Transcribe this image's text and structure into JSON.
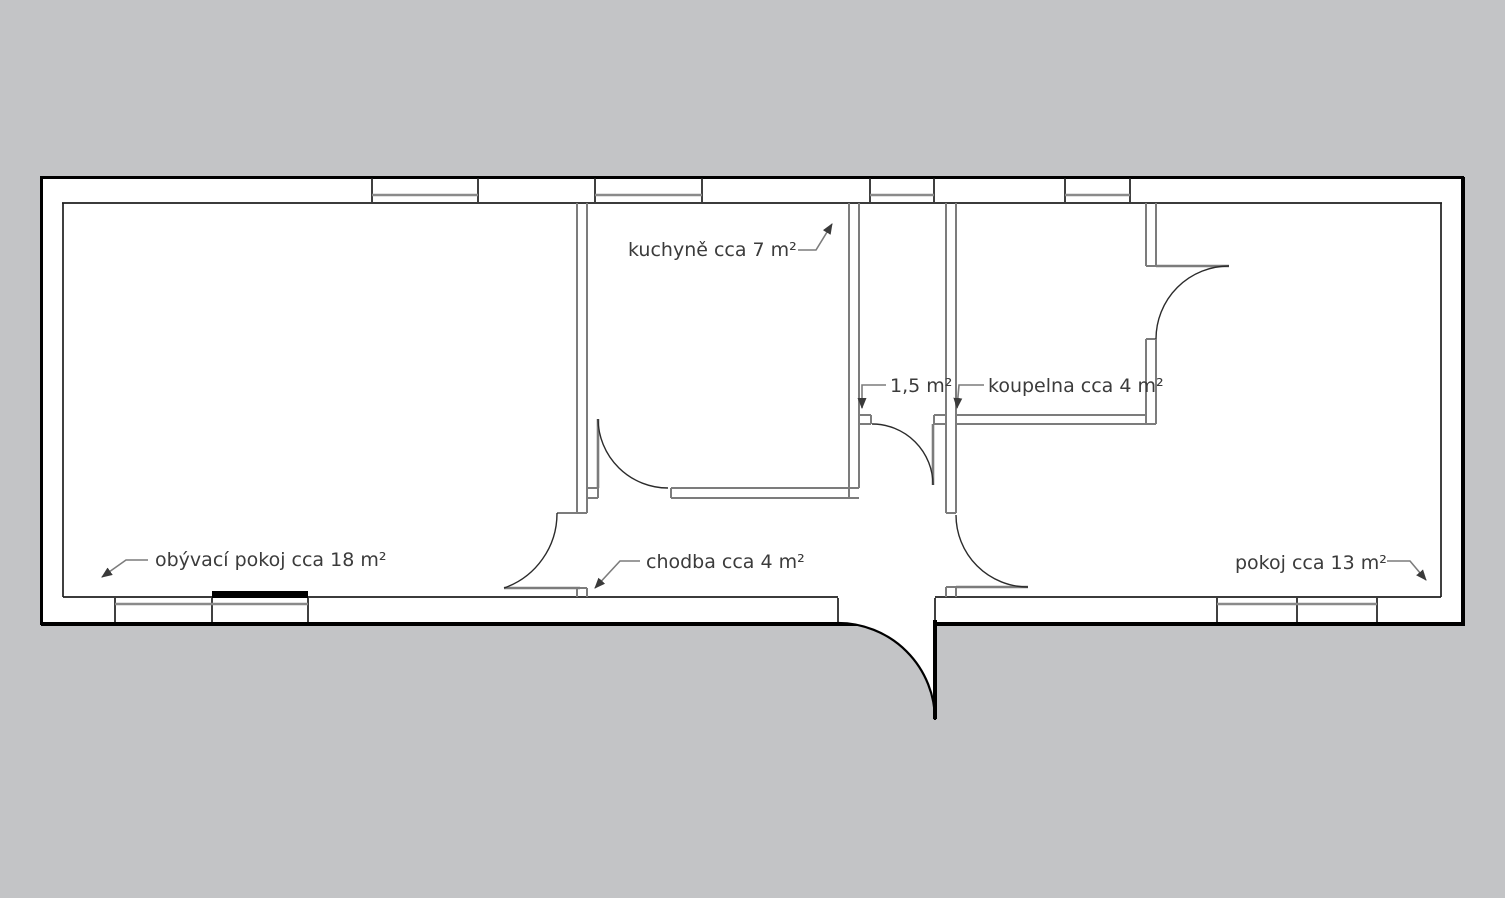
{
  "diagram_type": "apartment-floor-plan",
  "colors": {
    "page_background": "#c3c4c6",
    "plan_fill": "#ffffff",
    "outer_wall_line": "#000000",
    "partition_wall_line": "#7c7c7c",
    "label_text": "#3b3b3b"
  },
  "rooms": [
    {
      "id": "obyvaci-pokoj",
      "label": "obývací pokoj cca 18 m²"
    },
    {
      "id": "kuchyne",
      "label": "kuchyně cca 7 m²"
    },
    {
      "id": "chodba",
      "label": "chodba cca 4 m²"
    },
    {
      "id": "wc",
      "label": "1,5 m²"
    },
    {
      "id": "koupelna",
      "label": "koupelna cca 4 m²"
    },
    {
      "id": "pokoj",
      "label": "pokoj cca 13 m²"
    }
  ]
}
